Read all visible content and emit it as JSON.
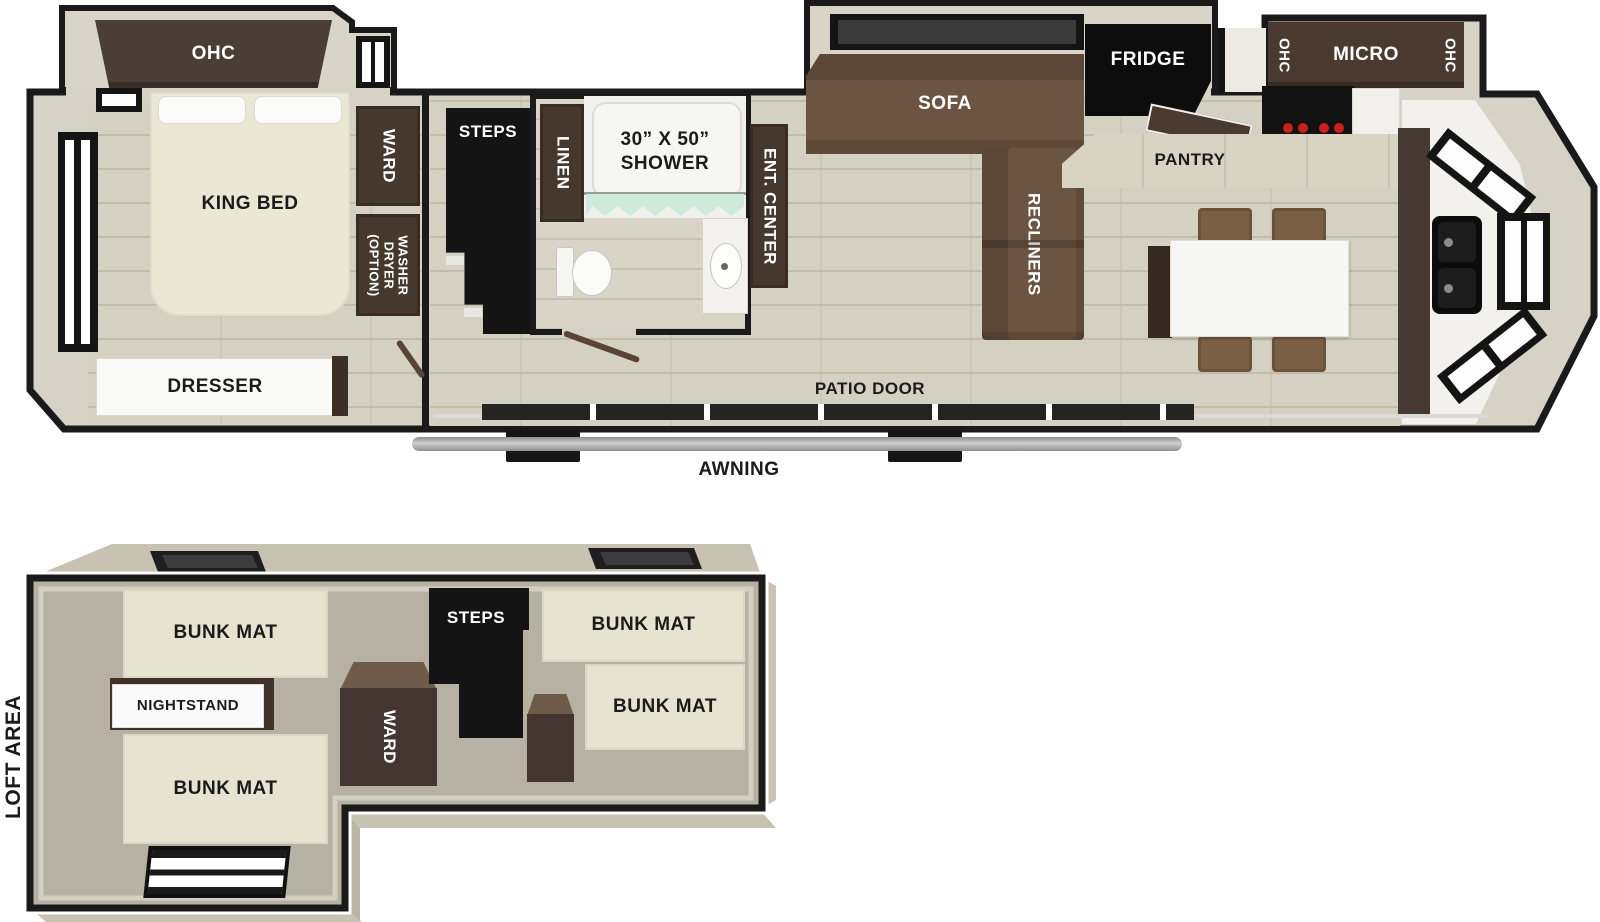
{
  "main_floor": {
    "bedroom": {
      "ohc": "OHC",
      "king_bed": "KING BED",
      "ward": "WARD",
      "washer_dryer": [
        "WASHER",
        "DRYER",
        "(OPTION)"
      ],
      "dresser": "DRESSER"
    },
    "entry": {
      "steps": "STEPS"
    },
    "bathroom": {
      "linen": "LINEN",
      "shower_size": "30” X 50”",
      "shower": "SHOWER"
    },
    "living_room": {
      "ent_center": "ENT. CENTER",
      "sofa": "SOFA",
      "recliners": "RECLINERS"
    },
    "kitchen": {
      "fridge": "FRIDGE",
      "pantry": "PANTRY",
      "ohc_left": "OHC",
      "micro": "MICRO",
      "ohc_right": "OHC"
    },
    "exterior": {
      "patio_door": "PATIO DOOR",
      "awning": "AWNING"
    }
  },
  "loft": {
    "area_label": "LOFT AREA",
    "bunk_mat_top_left": "BUNK MAT",
    "nightstand": "NIGHTSTAND",
    "bunk_mat_bottom_left": "BUNK MAT",
    "ward": "WARD",
    "steps": "STEPS",
    "bunk_mat_top_right": "BUNK MAT",
    "bunk_mat_mid_right": "BUNK MAT"
  },
  "colors": {
    "wall_outline": "#1a1a1a",
    "floor_wood": "#d5d1c2",
    "slide_floor": "#d8d4c8",
    "cabinet_dark_brown": "#47382e",
    "sofa_brown": "#6b5441",
    "bed_cream": "#ebe7d5",
    "appliance_black": "#0d0d0d",
    "counter_white": "#f2f1ed",
    "curtain_teal": "#cdeadb",
    "awning_gray": "#a8a8a8",
    "loft_floor": "#b6b1a2",
    "burner_red": "#c9201d"
  }
}
